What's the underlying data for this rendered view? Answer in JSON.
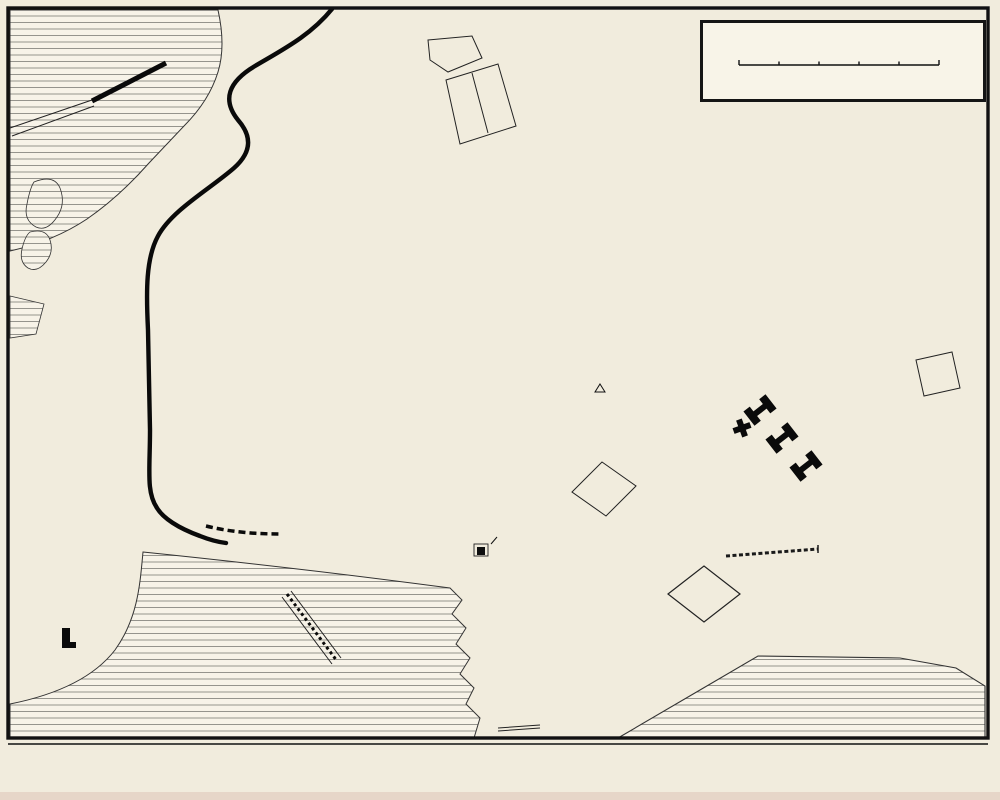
{
  "page": {
    "paper_color": "#f7f3e8",
    "ink_color": "#141414",
    "background": "#ece4d2"
  },
  "title_box": {
    "title": "TS'ING-TAU",
    "title_paren": "(TS'ING-TAO)",
    "scale_start": "0",
    "scale_end": "500 m"
  },
  "caption": {
    "publisher": "Guides Madrolle",
    "map_title": "CH'ING-TAO  (Chiao-chou Wan)",
    "cartographer": "Georges Huré"
  },
  "map_labels": [
    {
      "text": "Faber Hospital",
      "x": 464,
      "y": 31,
      "rot": 0,
      "cls": "pl"
    },
    {
      "text": "Evang. Mission",
      "x": 524,
      "y": 98,
      "rot": 0,
      "cls": "pl"
    },
    {
      "text": "Artill. Verw.",
      "x": 520,
      "y": 146,
      "rot": 0,
      "cls": "pl"
    },
    {
      "text": "Pulverschuppen",
      "x": 495,
      "y": 177,
      "rot": 0,
      "cls": "pl"
    },
    {
      "text": "Pulverschuppen",
      "x": 795,
      "y": 170,
      "rot": 0,
      "cls": "pl"
    },
    {
      "text": "KLEINER HAFEN",
      "x": 137,
      "y": 158,
      "rot": 0,
      "cls": "wat2"
    },
    {
      "text": "KLEINER HAFENWEG",
      "x": 228,
      "y": 116,
      "rot": 85,
      "cls": "st2"
    },
    {
      "text": "TSANGKOU STR.",
      "x": 297,
      "y": 192,
      "rot": -6,
      "cls": "st2"
    },
    {
      "text": "WEIHSIEN STR.",
      "x": 299,
      "y": 208,
      "rot": -8,
      "cls": "st2"
    },
    {
      "text": "TSIMO STR.",
      "x": 305,
      "y": 222,
      "rot": -8,
      "cls": "st2"
    },
    {
      "text": "KIAUTSCHOU STR.",
      "x": 302,
      "y": 238,
      "rot": -6,
      "cls": "st2"
    },
    {
      "text": "KAUMI STR.",
      "x": 311,
      "y": 251,
      "rot": -8,
      "cls": "st2"
    },
    {
      "text": "HAIPO STR.",
      "x": 309,
      "y": 265,
      "rot": -8,
      "cls": "st2"
    },
    {
      "text": "SIFANG STR.",
      "x": 306,
      "y": 288,
      "rot": -8,
      "cls": "st2"
    },
    {
      "text": "SCHANTUNG STR.",
      "x": 263,
      "y": 236,
      "rot": 80,
      "cls": "st2"
    },
    {
      "text": "TSCHIFU STR.",
      "x": 349,
      "y": 236,
      "rot": 80,
      "cls": "st2"
    },
    {
      "text": "TSINAN STR.",
      "x": 197,
      "y": 246,
      "rot": -38,
      "cls": "st"
    },
    {
      "text": "PEKING STR.",
      "x": 186,
      "y": 287,
      "rot": 72,
      "cls": "st2"
    },
    {
      "text": "HONAN STR.",
      "x": 209,
      "y": 301,
      "rot": 75,
      "cls": "st2"
    },
    {
      "text": "TIENTSIN STR.",
      "x": 239,
      "y": 290,
      "rot": -24,
      "cls": "st2"
    },
    {
      "text": "PAOTINGFU",
      "x": 248,
      "y": 321,
      "rot": 68,
      "cls": "st2"
    },
    {
      "text": "TAKU",
      "x": 199,
      "y": 342,
      "rot": 4,
      "cls": "st"
    },
    {
      "text": "BREMER",
      "x": 217,
      "y": 371,
      "rot": 6,
      "cls": "st"
    },
    {
      "text": "STR.",
      "x": 292,
      "y": 368,
      "rot": 6,
      "cls": "st"
    },
    {
      "text": "BERLINER",
      "x": 219,
      "y": 399,
      "rot": 6,
      "cls": "st"
    },
    {
      "text": "STR.",
      "x": 298,
      "y": 397,
      "rot": 6,
      "cls": "st"
    },
    {
      "text": "KRONPRINZEN",
      "x": 243,
      "y": 428,
      "rot": 6,
      "cls": "st"
    },
    {
      "text": "STR.",
      "x": 305,
      "y": 426,
      "rot": 6,
      "cls": "st"
    },
    {
      "text": "IRENE",
      "x": 210,
      "y": 456,
      "rot": 5,
      "cls": "st"
    },
    {
      "text": "STR.",
      "x": 252,
      "y": 458,
      "rot": 5,
      "cls": "st"
    },
    {
      "text": "IRENE",
      "x": 331,
      "y": 469,
      "rot": 8,
      "cls": "st"
    },
    {
      "text": "PRINZ",
      "x": 215,
      "y": 492,
      "rot": 8,
      "cls": "st"
    },
    {
      "text": "HEINRICH",
      "x": 304,
      "y": 498,
      "rot": 8,
      "cls": "st"
    },
    {
      "text": "HOHENZOLLERN",
      "x": 233,
      "y": 513,
      "rot": 10,
      "cls": "st"
    },
    {
      "text": "STR.",
      "x": 283,
      "y": 524,
      "rot": 10,
      "cls": "st"
    },
    {
      "text": "KAISER",
      "x": 195,
      "y": 538,
      "rot": 14,
      "cls": "st"
    },
    {
      "text": "WILHELM",
      "x": 267,
      "y": 539,
      "rot": -4,
      "cls": "st"
    },
    {
      "text": "UFER",
      "x": 318,
      "y": 548,
      "rot": -6,
      "cls": "st"
    },
    {
      "text": "KIELER STR.",
      "x": 161,
      "y": 391,
      "rot": 80,
      "cls": "st2"
    },
    {
      "text": "WILHELMSHAVENER",
      "x": 212,
      "y": 376,
      "rot": 85,
      "cls": "st2"
    },
    {
      "text": "Bahnhof",
      "x": 141,
      "y": 505,
      "rot": 0,
      "cls": "pl"
    },
    {
      "text": "PINELL STR.",
      "x": 334,
      "y": 326,
      "rot": -35,
      "cls": "st2"
    },
    {
      "text": "WEG",
      "x": 351,
      "y": 358,
      "rot": -40,
      "cls": "st2"
    },
    {
      "text": "LAUSCHAN STR.",
      "x": 398,
      "y": 340,
      "rot": -14,
      "cls": "st"
    },
    {
      "text": "LAZARETH WEG",
      "x": 460,
      "y": 361,
      "rot": 55,
      "cls": "st"
    },
    {
      "text": "Gouvernements",
      "x": 424,
      "y": 374,
      "rot": 0,
      "cls": "plb"
    },
    {
      "text": "Hügel",
      "x": 421,
      "y": 390,
      "rot": 0,
      "cls": "plb"
    },
    {
      "text": "HOHENLOHE WEG",
      "x": 390,
      "y": 417,
      "rot": 82,
      "cls": "st2"
    },
    {
      "text": "MOLTKE STR.",
      "x": 531,
      "y": 227,
      "rot": 78,
      "cls": "st2"
    },
    {
      "text": "KIAUTSCHOU STR.",
      "x": 449,
      "y": 212,
      "rot": -14,
      "cls": "st"
    },
    {
      "text": "Wasser Réservoir",
      "x": 472,
      "y": 291,
      "rot": 0,
      "cls": "pl"
    },
    {
      "text": "Garnison Lazareth",
      "x": 506,
      "y": 329,
      "rot": 0,
      "cls": "pl"
    },
    {
      "text": "Bataillons haus",
      "x": 446,
      "y": 437,
      "rot": 0,
      "cls": "pl"
    },
    {
      "text": "DIEDERICHS WEG",
      "x": 455,
      "y": 459,
      "rot": -22,
      "cls": "st2"
    },
    {
      "text": "BISMARCK STR.",
      "x": 474,
      "y": 506,
      "rot": 78,
      "cls": "st2"
    },
    {
      "text": "Schule",
      "x": 517,
      "y": 477,
      "rot": 0,
      "cls": "pl"
    },
    {
      "text": "Ev. Kapelle",
      "x": 529,
      "y": 496,
      "rot": 0,
      "cls": "pl"
    },
    {
      "text": "Tempel",
      "x": 502,
      "y": 539,
      "rot": 0,
      "cls": "pl"
    },
    {
      "text": "Baracken",
      "x": 636,
      "y": 480,
      "rot": 0,
      "cls": "pl"
    },
    {
      "text": "Diederichs Berg",
      "x": 655,
      "y": 397,
      "rot": -2,
      "cls": "pli2"
    },
    {
      "text": "Bismarck Kasernen",
      "x": 855,
      "y": 411,
      "rot": 0,
      "cls": "pl"
    },
    {
      "text": "Europäer",
      "x": 954,
      "y": 415,
      "rot": 0,
      "cls": "pli"
    },
    {
      "text": "Friedhof",
      "x": 953,
      "y": 429,
      "rot": 0,
      "cls": "pli"
    },
    {
      "text": "OSTPASS STR.",
      "x": 813,
      "y": 195,
      "rot": -48,
      "cls": "st"
    },
    {
      "text": "OSTPASS STR.",
      "x": 710,
      "y": 464,
      "rot": 68,
      "cls": "st2"
    },
    {
      "text": "OSTPASS",
      "x": 670,
      "y": 528,
      "rot": -55,
      "cls": "st"
    },
    {
      "text": "OSTLAGER",
      "x": 595,
      "y": 535,
      "rot": -20,
      "cls": "st"
    },
    {
      "text": "Schiess Stand",
      "x": 730,
      "y": 544,
      "rot": 0,
      "cls": "pl"
    },
    {
      "text": "Artillerie",
      "x": 737,
      "y": 581,
      "rot": 0,
      "cls": "pl"
    },
    {
      "text": "Lager",
      "x": 737,
      "y": 595,
      "rot": 0,
      "cls": "pl"
    },
    {
      "text": "ILTISPASS",
      "x": 635,
      "y": 597,
      "rot": 24,
      "cls": "st"
    },
    {
      "text": "YAMEN ST.",
      "x": 565,
      "y": 588,
      "rot": 70,
      "cls": "st2"
    },
    {
      "text": "ILTISPASS STR.",
      "x": 887,
      "y": 638,
      "rot": -11,
      "cls": "st"
    },
    {
      "text": "Exerzier",
      "x": 929,
      "y": 678,
      "rot": 0,
      "cls": "pli2"
    },
    {
      "text": "Platz",
      "x": 925,
      "y": 698,
      "rot": 0,
      "cls": "pli2"
    },
    {
      "text": "AUGUSTE VICTORIA UFER",
      "x": 717,
      "y": 703,
      "rot": -29,
      "cls": "st2"
    },
    {
      "text": "AUGUSTE VICTORIA-BUCHT",
      "x": 806,
      "y": 736,
      "rot": -3,
      "cls": "watm"
    },
    {
      "text": "AUGUSTE VICTORIA",
      "x": 574,
      "y": 688,
      "rot": 74,
      "cls": "st2"
    },
    {
      "text": "Baracken",
      "x": 645,
      "y": 658,
      "rot": 0,
      "cls": "pl"
    },
    {
      "text": "Tamen Brücke",
      "x": 491,
      "y": 698,
      "rot": -20,
      "cls": "pl"
    },
    {
      "text": "Bootsslip",
      "x": 478,
      "y": 727,
      "rot": 0,
      "cls": "pl"
    },
    {
      "text": "Tsingtau Brücke",
      "x": 292,
      "y": 626,
      "rot": 55,
      "cls": "pli"
    },
    {
      "text": "AUSSEN-RHEDE",
      "x": 318,
      "y": 682,
      "rot": -1,
      "cls": "wat"
    },
    {
      "text": "KRONPRINZEN UFER",
      "x": 128,
      "y": 616,
      "rot": 62,
      "cls": "st2"
    },
    {
      "text": "Feld",
      "x": 78,
      "y": 647,
      "rot": 0,
      "cls": "pl"
    },
    {
      "text": "Artill.",
      "x": 81,
      "y": 659,
      "rot": 0,
      "cls": "pl"
    },
    {
      "text": "Kaserne",
      "x": 86,
      "y": 671,
      "rot": 0,
      "cls": "pl"
    },
    {
      "text": "100 m.",
      "x": 622,
      "y": 354,
      "rot": 0,
      "cls": "ct"
    },
    {
      "text": "80",
      "x": 619,
      "y": 431,
      "rot": 0,
      "cls": "ct"
    },
    {
      "text": "120",
      "x": 904,
      "y": 322,
      "rot": 0,
      "cls": "ct"
    },
    {
      "text": "100",
      "x": 906,
      "y": 337,
      "rot": 0,
      "cls": "ct"
    },
    {
      "text": "80",
      "x": 885,
      "y": 391,
      "rot": 0,
      "cls": "ct"
    },
    {
      "text": "60",
      "x": 862,
      "y": 424,
      "rot": 0,
      "cls": "ct"
    },
    {
      "text": "160",
      "x": 633,
      "y": 464,
      "rot": 0,
      "cls": "ct"
    },
    {
      "text": "60",
      "x": 839,
      "y": 549,
      "rot": 0,
      "cls": "ct"
    },
    {
      "text": "40",
      "x": 853,
      "y": 558,
      "rot": 0,
      "cls": "ct"
    },
    {
      "text": "20",
      "x": 868,
      "y": 565,
      "rot": 0,
      "cls": "ct"
    }
  ]
}
